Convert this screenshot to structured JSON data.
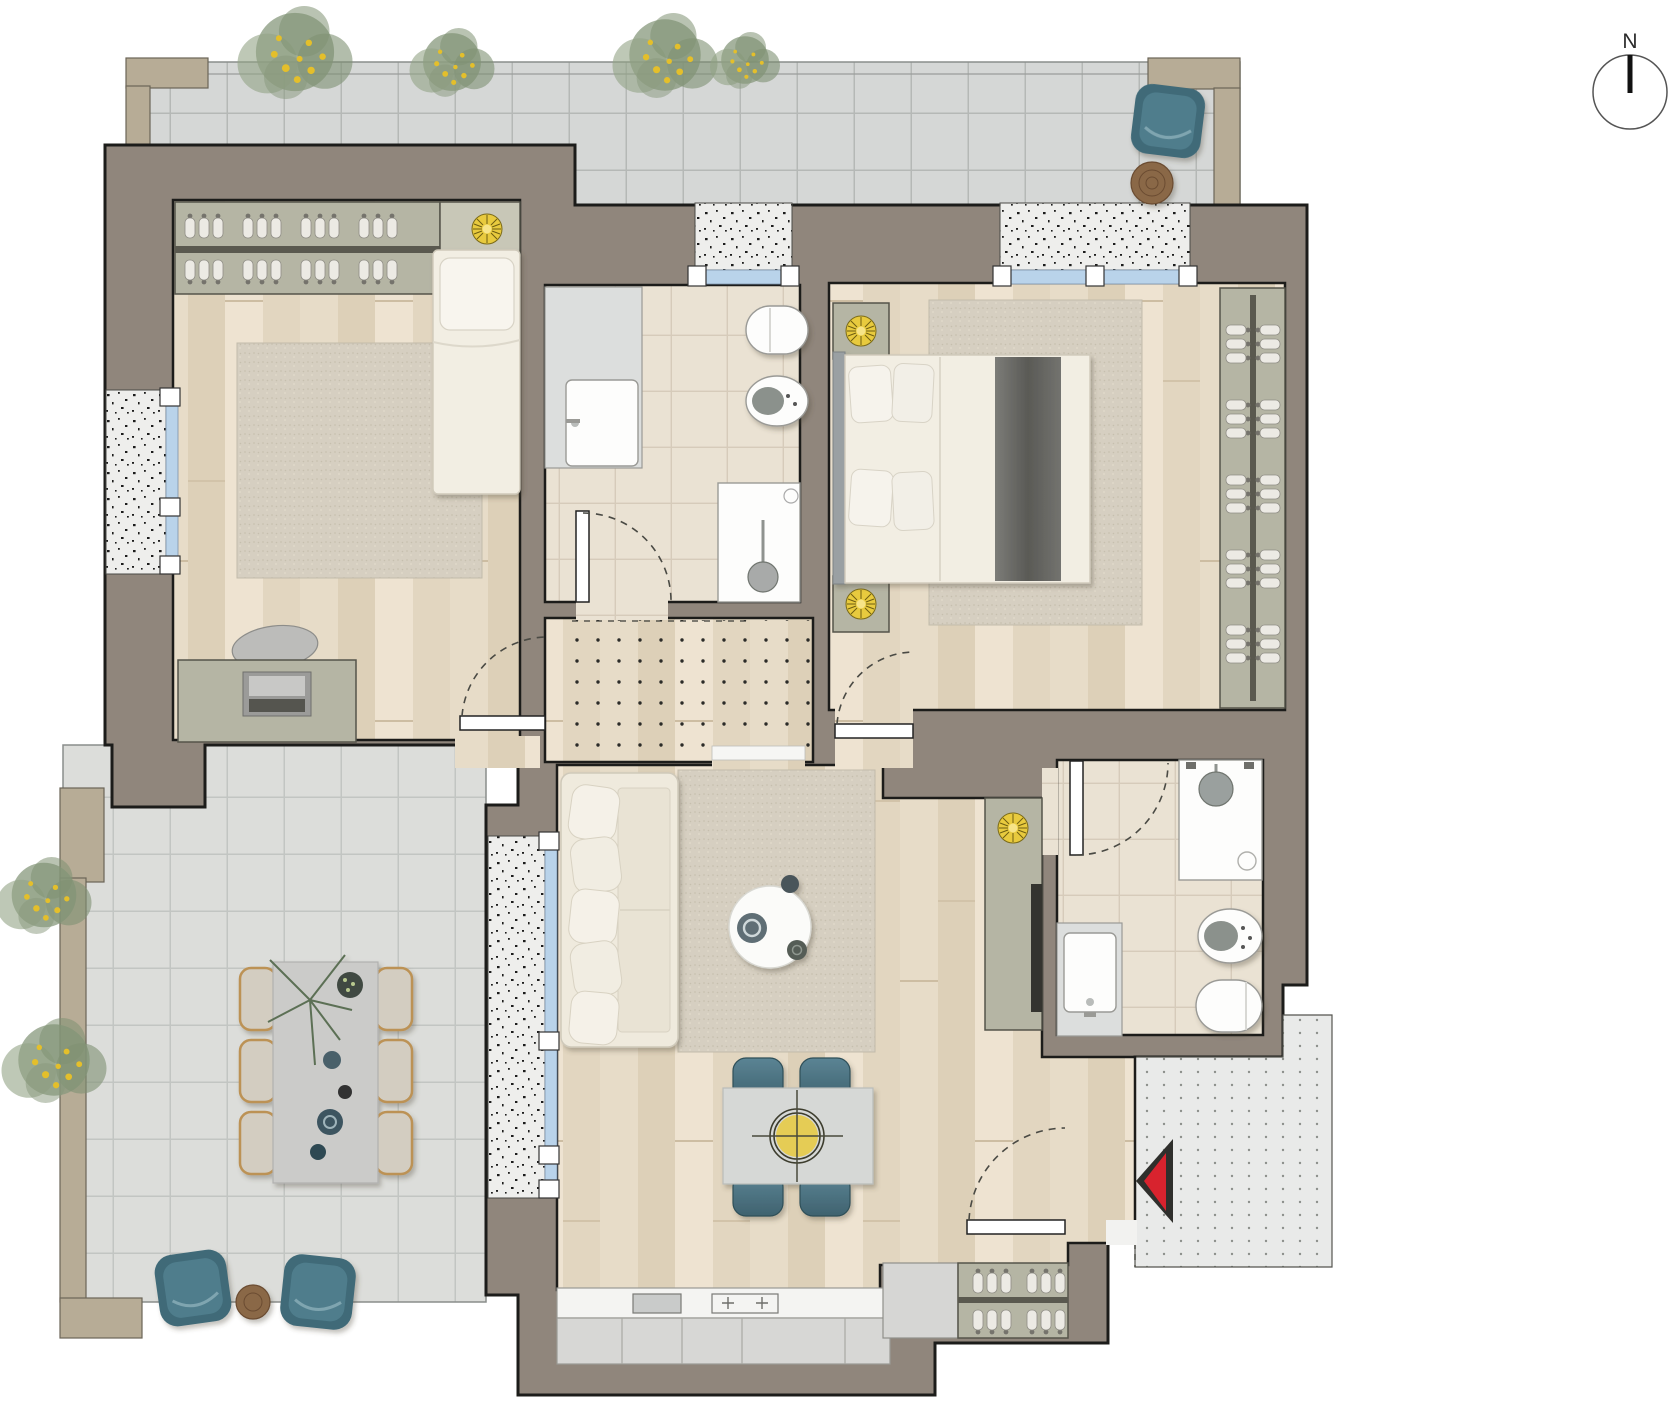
{
  "compass": {
    "label": "N"
  },
  "palette": {
    "wall": "#90867c",
    "outline": "#1c1c1a",
    "tan": "#b7ac96",
    "wood1": "#e7dcc8",
    "wood2": "#ddd0b8",
    "wood3": "#eee3d1",
    "wood4": "#e2d6c0",
    "tile": "#eae2d3",
    "tileline": "#d6cbba",
    "terr1": "#d5d7d6",
    "terr1line": "#b5b8b6",
    "terr2": "#dcddda",
    "terr2line": "#c2c5c2",
    "cabinet": "#b5b5a4",
    "cabinetlight": "#c8c7b7",
    "rug1": "#d6cfc1",
    "rug2": "#cdc6b6",
    "speckle": "#eeeeec",
    "glass": "#b9d3ea",
    "whitefurn": "#f2eee3",
    "fixture": "#fdfdfc",
    "yellow": "#e8ca3e",
    "teal": "#4e7a89",
    "wicker": "#bc9255",
    "woodtable": "#8a6847",
    "red": "#d8232e",
    "landing": "#e9eae9",
    "tv": "#34342f"
  },
  "plan": {
    "rooms": {
      "bedroom_1": [
        "wardrobe-hangers",
        "ceiling-light",
        "single-bed",
        "rug",
        "desk",
        "laptop",
        "desk-chair",
        "window",
        "door"
      ],
      "bathroom_1": [
        "washbasin",
        "toilet",
        "bidet",
        "shower",
        "window",
        "door"
      ],
      "bedroom_2": [
        "nightstand-light",
        "nightstand-light",
        "double-bed",
        "rug",
        "wardrobe-hangers",
        "window",
        "door"
      ],
      "hallway": [
        "dotted-floor"
      ],
      "living_room": [
        "sofa",
        "rug",
        "coffee-table",
        "dining-table",
        "dining-chairs-4",
        "pendant-light",
        "tv-cabinet",
        "kitchen-counter",
        "sink",
        "cooktop",
        "entry-closet"
      ],
      "bathroom_2": [
        "shower",
        "bidet",
        "toilet",
        "washbasin",
        "door"
      ],
      "terrace_top": [
        "plants",
        "lounge-chair",
        "side-table"
      ],
      "terrace_left": [
        "plants",
        "outdoor-dining-table",
        "outdoor-chairs-6",
        "lounge-chairs-2",
        "side-table"
      ],
      "entry_landing": [
        "entry-arrow"
      ]
    }
  }
}
